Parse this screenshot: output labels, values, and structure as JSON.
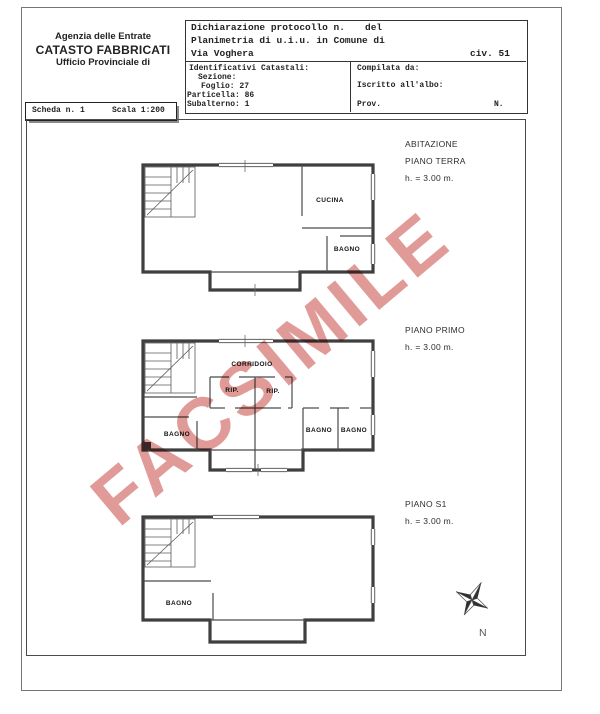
{
  "header": {
    "line1": "Agenzia delle Entrate",
    "line2": "CATASTO FABBRICATI",
    "line3": "Ufficio Provinciale di"
  },
  "scheda": {
    "left": "Scheda n. 1",
    "right": "Scala 1:200"
  },
  "declaration": {
    "protocol_label": "Dichiarazione protocollo n.",
    "del_label": "del",
    "planimetria": "Planimetria di u.i.u. in Comune di",
    "street": "Via Voghera",
    "civ": "civ. 51"
  },
  "cadastral": {
    "title": "Identificativi Catastali:",
    "sezione": "Sezione:",
    "foglio": "Foglio: 27",
    "particella": "Particella: 86",
    "subalterno": "Subalterno: 1"
  },
  "compiled": {
    "compilata": "Compilata da:",
    "iscritto": "Iscritto all'albo:",
    "prov": "Prov.",
    "n": "N."
  },
  "floors": [
    {
      "name": "ABITAZIONE",
      "title": "PIANO TERRA",
      "height": "h. = 3.00 m.",
      "rooms": {
        "cucina": "CUCINA",
        "bagno": "BAGNO"
      }
    },
    {
      "title": "PIANO PRIMO",
      "height": "h. = 3.00 m.",
      "rooms": {
        "corridoio": "CORRIDOIO",
        "rip1": "RIP.",
        "rip2": "RIP.",
        "bagno1": "BAGNO",
        "bagno2": "BAGNO",
        "bagno3": "BAGNO"
      }
    },
    {
      "title": "PIANO S1",
      "height": "h. = 3.00 m.",
      "rooms": {
        "bagno": "BAGNO"
      }
    }
  ],
  "compass": {
    "label": "N"
  },
  "watermark": {
    "text": "FACSIMILE",
    "color": "#db8a86"
  }
}
